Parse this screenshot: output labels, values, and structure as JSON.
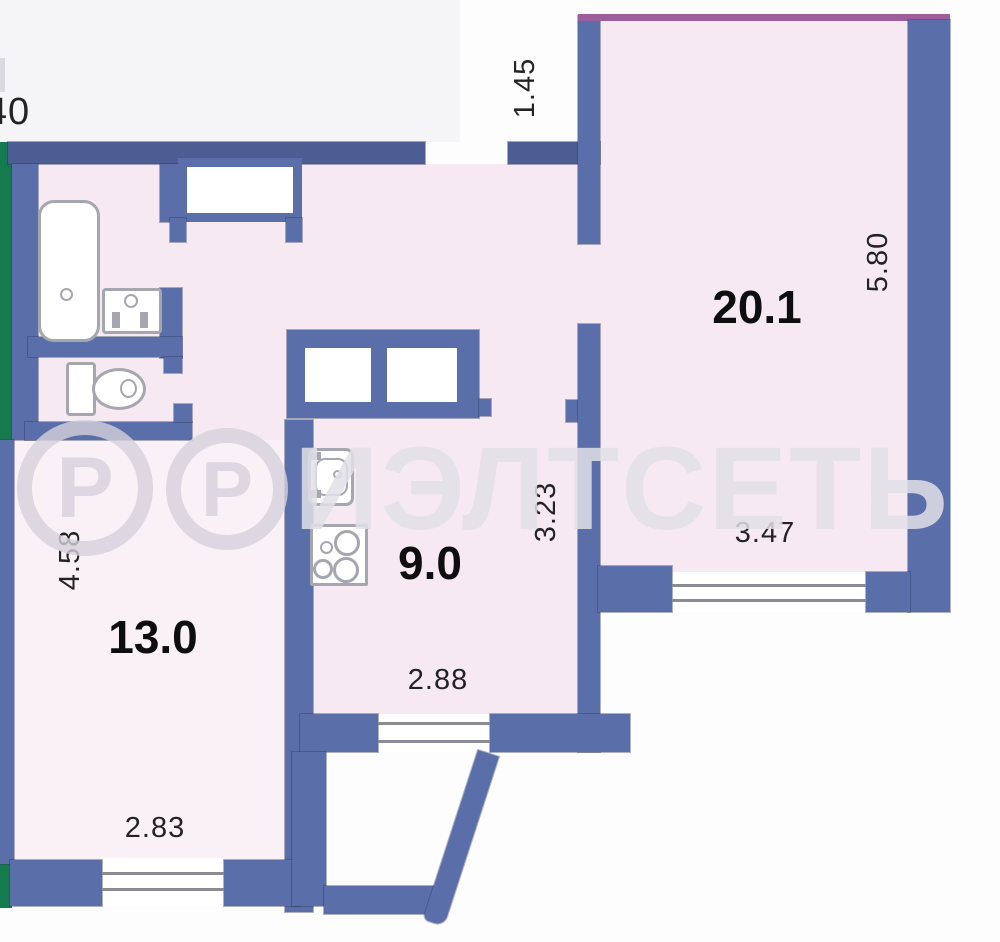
{
  "plan_title": "apartment-floor-plan",
  "rooms": [
    {
      "id": "living",
      "area": "20.1",
      "width": "3.47",
      "height": "5.80"
    },
    {
      "id": "kitchen",
      "area": "9.0",
      "width": "2.88",
      "height": "3.23"
    },
    {
      "id": "bedroom",
      "area": "13.0",
      "width": "2.83",
      "height": "4.58"
    }
  ],
  "labels": {
    "edge_partial": "40",
    "entry_depth": "1.45"
  },
  "watermark": {
    "symbol": "Р",
    "text": "ИЭЛТСЕТЬ"
  },
  "colors": {
    "wall": "#5a6fa9",
    "wall_dark": "#4c5d94",
    "green": "#157a4e",
    "purple": "#9c5f9c",
    "floor": "#f6e9f1",
    "floor_light": "#f9f1f6",
    "window_line": "#8b8b93",
    "fixture": "#a6a6b0",
    "text": "#232323",
    "watermark": "rgba(226,223,231,0.85)",
    "watermark_ring": "rgba(213,209,219,0.8)"
  }
}
